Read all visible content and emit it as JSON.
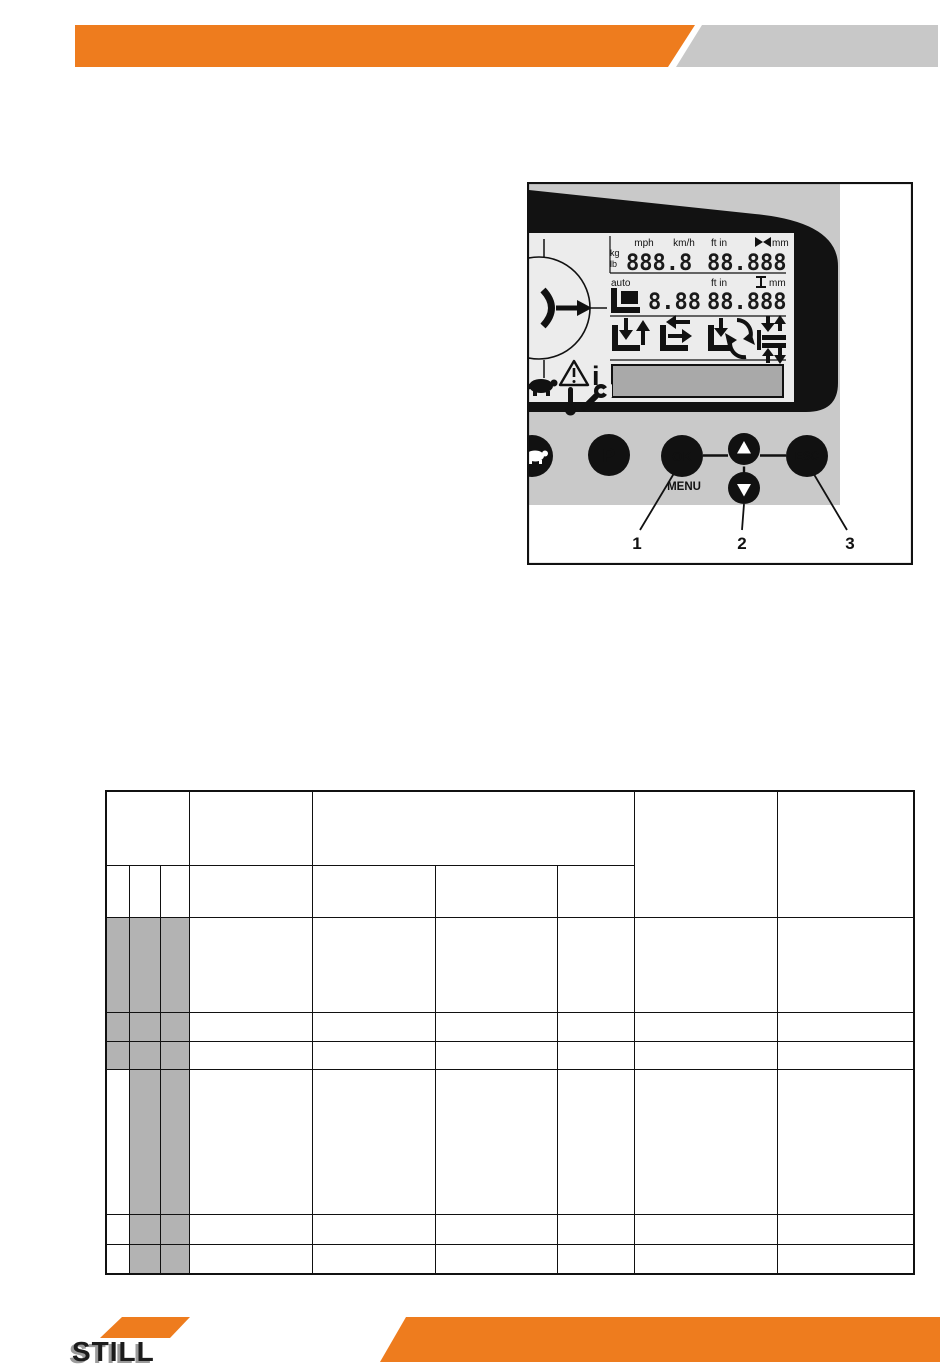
{
  "colors": {
    "brand_orange": "#ee7c1e",
    "header_gray": "#c8c8c8",
    "panel_gray": "#c9c9c9",
    "screen_gray": "#ececec",
    "table_shade_gray": "#b3b3b3",
    "message_box_gray": "#a9a9a9"
  },
  "diagram": {
    "display": {
      "unit_mph": "mph",
      "unit_kmh": "km/h",
      "unit_ftin_top": "ft in",
      "unit_mm_top": "mm",
      "unit_kg": "kg",
      "unit_lb": "lb",
      "value_weight": "888.8",
      "value_distance_top": "88.888",
      "label_auto": "auto",
      "unit_ftin_mid": "ft in",
      "unit_mm_mid": "mm",
      "value_mid_small": "8.88",
      "value_mid_large": "88.888",
      "info_glyph": "i"
    },
    "buttons": {
      "park": "P",
      "ok": "OK",
      "menu": "MENU",
      "esc": "ESC"
    },
    "callouts": {
      "one": "1",
      "two": "2",
      "three": "3"
    },
    "icon_names": [
      "steering-indicator",
      "tilt-icon",
      "height-icon",
      "fork-icon",
      "lift-height-icon",
      "lift-preselect-icon",
      "auto-rotate-icon",
      "shelf-levels-icon",
      "warning-triangle-icon",
      "info-icon",
      "turtle-icon",
      "thermometer-icon",
      "wrench-icon",
      "turtle-button",
      "park-button",
      "ok-menu-button",
      "arrow-up-button",
      "arrow-down-button",
      "esc-button"
    ]
  },
  "footer": {
    "brand": "STILL"
  },
  "table": {
    "shaded_color": "#b3b3b3",
    "col_widths": [
      23,
      31,
      29,
      123,
      123,
      122,
      77,
      143,
      137
    ],
    "rows": [
      {
        "h": 74,
        "cells": [
          {
            "cs": 3
          },
          {},
          {
            "cs": 3
          },
          {
            "rs": 2
          },
          {
            "rs": 2
          }
        ]
      },
      {
        "h": 52,
        "cells": [
          {},
          {},
          {},
          {},
          {},
          {},
          {}
        ]
      },
      {
        "h": 95,
        "cells": [
          {
            "shaded": true
          },
          {
            "shaded": true
          },
          {
            "shaded": true
          },
          {},
          {},
          {},
          {},
          {},
          {}
        ]
      },
      {
        "h": 29,
        "cells": [
          {
            "shaded": true
          },
          {
            "shaded": true
          },
          {
            "shaded": true
          },
          {},
          {},
          {},
          {},
          {},
          {}
        ]
      },
      {
        "h": 28,
        "cells": [
          {
            "shaded": true
          },
          {
            "shaded": true
          },
          {
            "shaded": true
          },
          {},
          {},
          {},
          {},
          {},
          {}
        ]
      },
      {
        "h": 145,
        "cells": [
          {},
          {
            "shaded": true
          },
          {
            "shaded": true
          },
          {},
          {},
          {},
          {},
          {},
          {}
        ]
      },
      {
        "h": 30,
        "cells": [
          {},
          {
            "shaded": true
          },
          {
            "shaded": true
          },
          {},
          {},
          {},
          {},
          {},
          {}
        ]
      },
      {
        "h": 30,
        "cells": [
          {},
          {
            "shaded": true
          },
          {
            "shaded": true
          },
          {},
          {},
          {},
          {},
          {},
          {}
        ]
      }
    ]
  }
}
